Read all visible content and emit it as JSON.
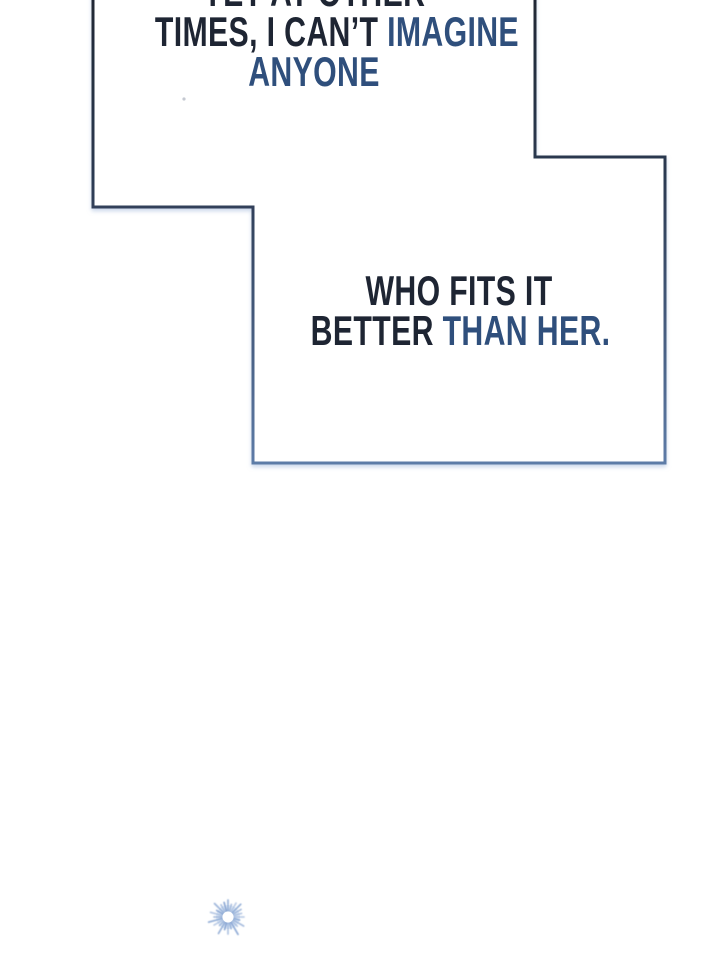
{
  "comic": {
    "background_color": "#ffffff",
    "panel": {
      "fill": "#ffffff",
      "border_top_color": "#1f2733",
      "border_mid_color": "#2c3a52",
      "border_bottom_color": "#5d7ba7",
      "glow_color": "#9db4d9"
    },
    "text_colors": {
      "dark": "#1e2533",
      "blue": "#2f4f7c"
    },
    "bubble1": {
      "line1_dark": "YET AT OTHER",
      "line2_dark": "TIMES, I CAN’T ",
      "line2_blue": "IMAGINE",
      "line3_blue": "ANYONE"
    },
    "bubble2": {
      "line1_dark": "WHO FITS IT",
      "line2_dark": "BETTER ",
      "line2_blue": "THAN HER."
    },
    "sparkle_color": "#6e92c9",
    "sparkle_halo_color": "#ccdcf0",
    "speck_color": "#b6bcc6"
  }
}
